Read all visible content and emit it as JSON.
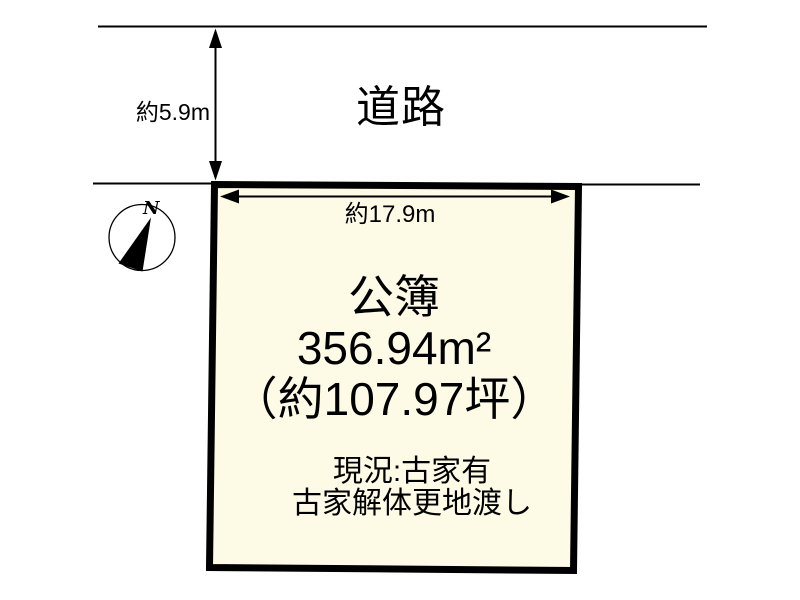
{
  "road": {
    "label": "道路",
    "width_label": "約5.9m"
  },
  "plot": {
    "frontage_label": "約17.9m",
    "register_label": "公簿",
    "area_sqm": "356.94m²",
    "area_tsubo": "（約107.97坪）",
    "status_line1": "現況:古家有",
    "status_line2": "古家解体更地渡し",
    "fill_color": "#fdfbe6",
    "border_color": "#000000",
    "line_color": "#000000"
  },
  "compass": {
    "north_label": "N"
  }
}
